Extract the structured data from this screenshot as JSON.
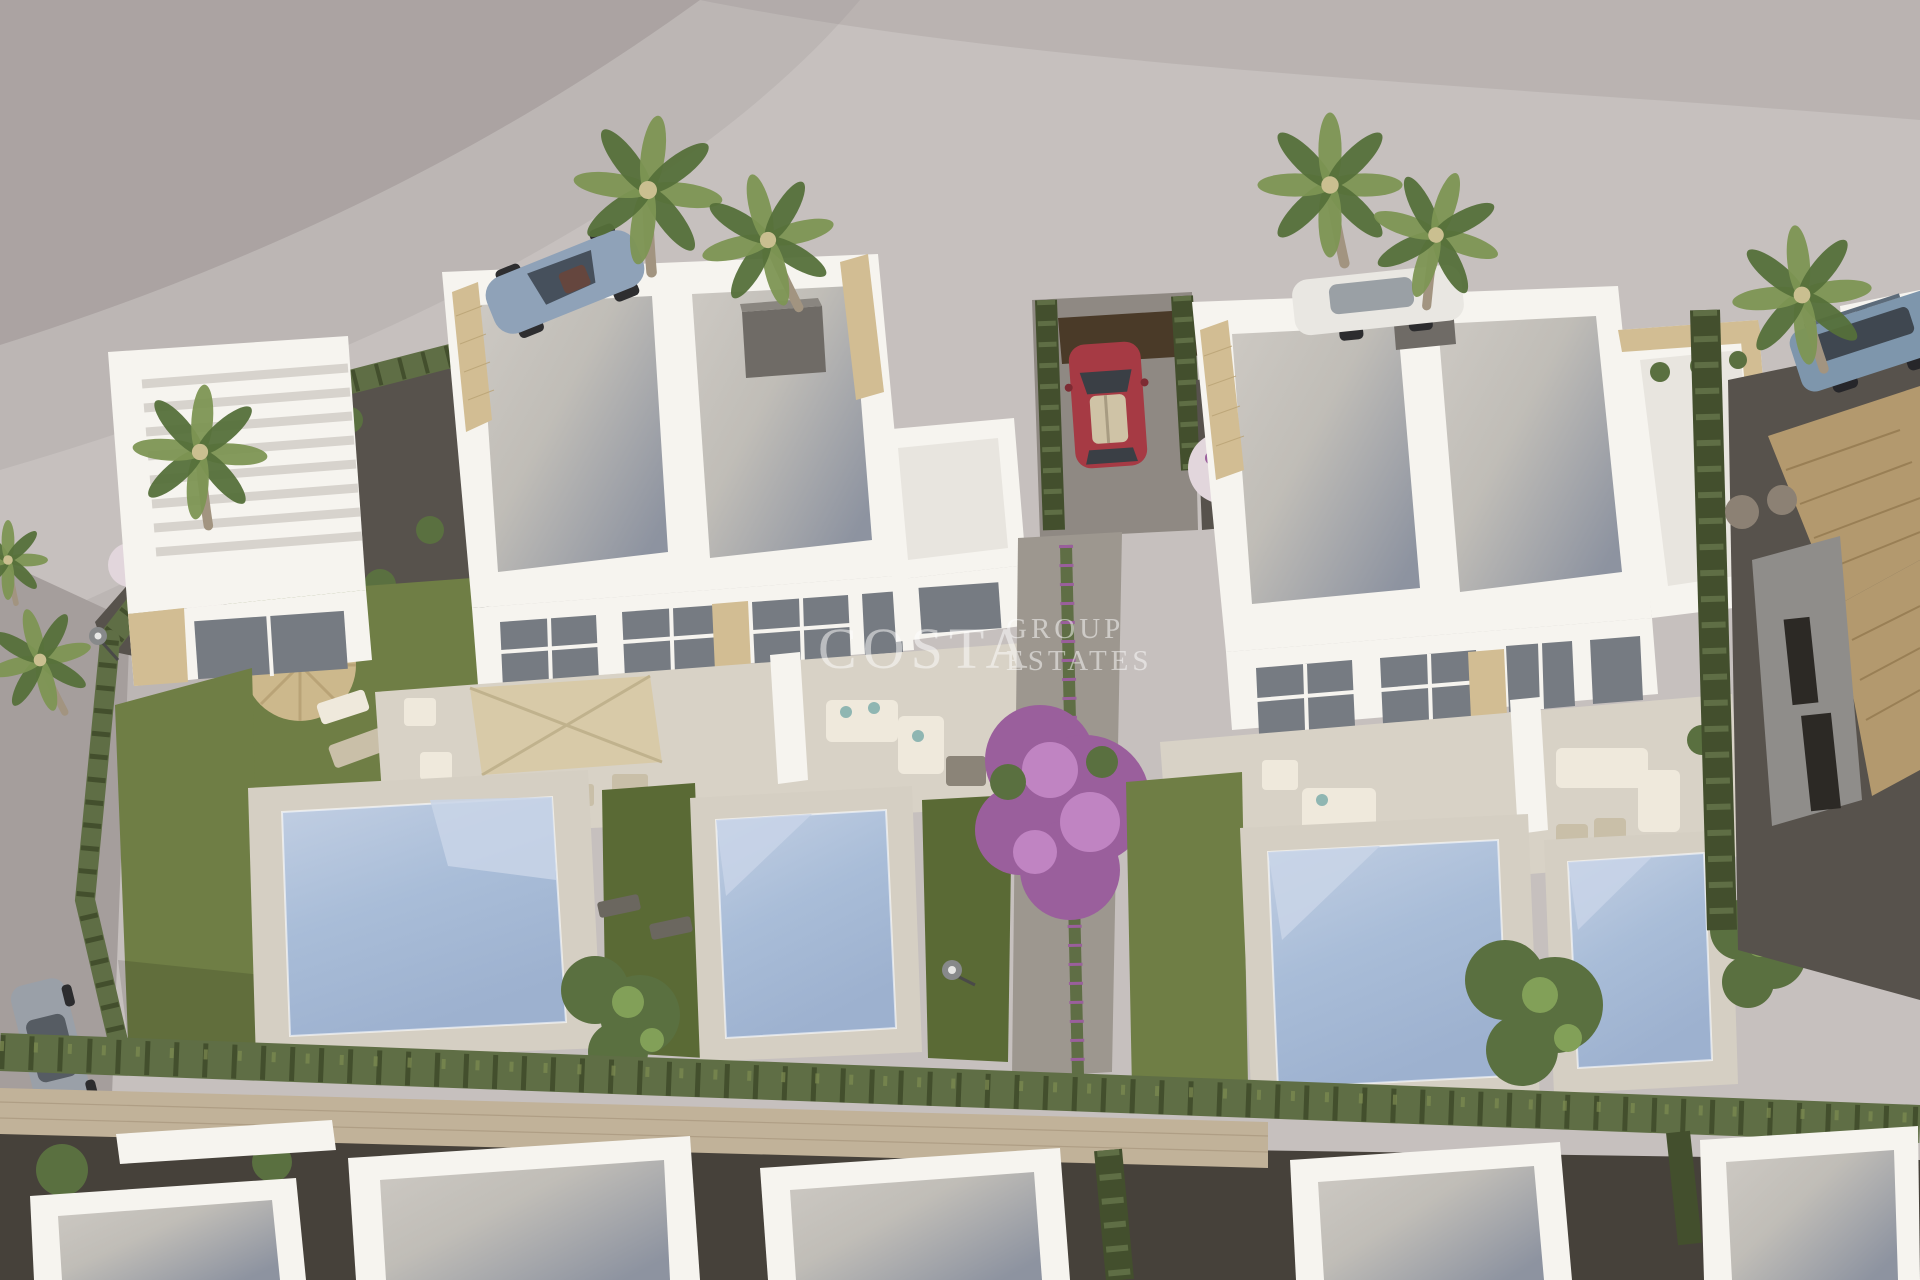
{
  "scene": {
    "description": "Aerial 3D architectural render of two modern white duplex villas with private pools, lawns, cypress hedges, palm trees and parked cars",
    "objects": [
      "road",
      "left-duplex-villa",
      "right-duplex-villa",
      "swimming-pools",
      "lawns",
      "cypress-hedges",
      "palm-trees",
      "bougainvillea-tree",
      "parked-cars",
      "garden-furniture",
      "neighbor-house-tiled-roof",
      "bottom-row-houses",
      "stone-perimeter-wall"
    ]
  },
  "watermark": {
    "brand": "COSTA",
    "sub1": "GROUP",
    "sub2": "ESTATES",
    "opacity": "0.5"
  },
  "colors": {
    "ground_upper": "#aba3a2",
    "ground_road": "#c6c0be",
    "street_gray": "#a59e9c",
    "shadow_soft": "#8e8889",
    "villa_white": "#f6f4ef",
    "villa_shadow": "#dedad3",
    "annex_roof": "#e8e5df",
    "stone_clad": "#d2bd93",
    "stone_wall": "#c1b299",
    "window_glass": "#767b82",
    "terrace_floor": "#d8d2c6",
    "pool_deck": "#d5cfc3",
    "pool_water": "#a9bdd8",
    "pool_water_light": "#c9d5e8",
    "lawn": "#6f7e45",
    "lawn_dark": "#5a6a35",
    "hedge_green": "#5f6e45",
    "hedge_dark": "#434f2d",
    "hedge_light": "#7d8c51",
    "gravel_mid": "#57524c",
    "gravel_dark": "#46413a",
    "drive_gray": "#8f8983",
    "path_gray": "#9d978f",
    "slab_white": "#d9d4cc",
    "wood_gate": "#4a3a28",
    "chimney_gray": "#6f6b66",
    "tile_roof": "#b3996e",
    "wall_gray": "#8f8d8a",
    "window_dark": "#2c2925",
    "stone_ball": "#8c8174",
    "bougainvillea": "#9a5f9c",
    "bougainvillea_light": "#c084c2",
    "flower_pink": "#c98bb7",
    "flower_white": "#e2d6dc",
    "tree_green": "#5a7040",
    "tree_light": "#82a058",
    "palm_green": "#7d9553",
    "palm_dark": "#55703a",
    "palm_trunk": "#a29480",
    "car_silver": "#8fa2b8",
    "car_red": "#a63a44",
    "car_white": "#e9e7e2",
    "car_blue": "#7e96ac",
    "car_gray": "#9aa0a8",
    "furniture_white": "#efe9dc",
    "furniture_tan": "#c9bfa8",
    "parasol_straw": "#ccb88c",
    "parasol_beige": "#d8caa8",
    "lamp_gray": "#87898a",
    "watermark": "#ffffff"
  }
}
